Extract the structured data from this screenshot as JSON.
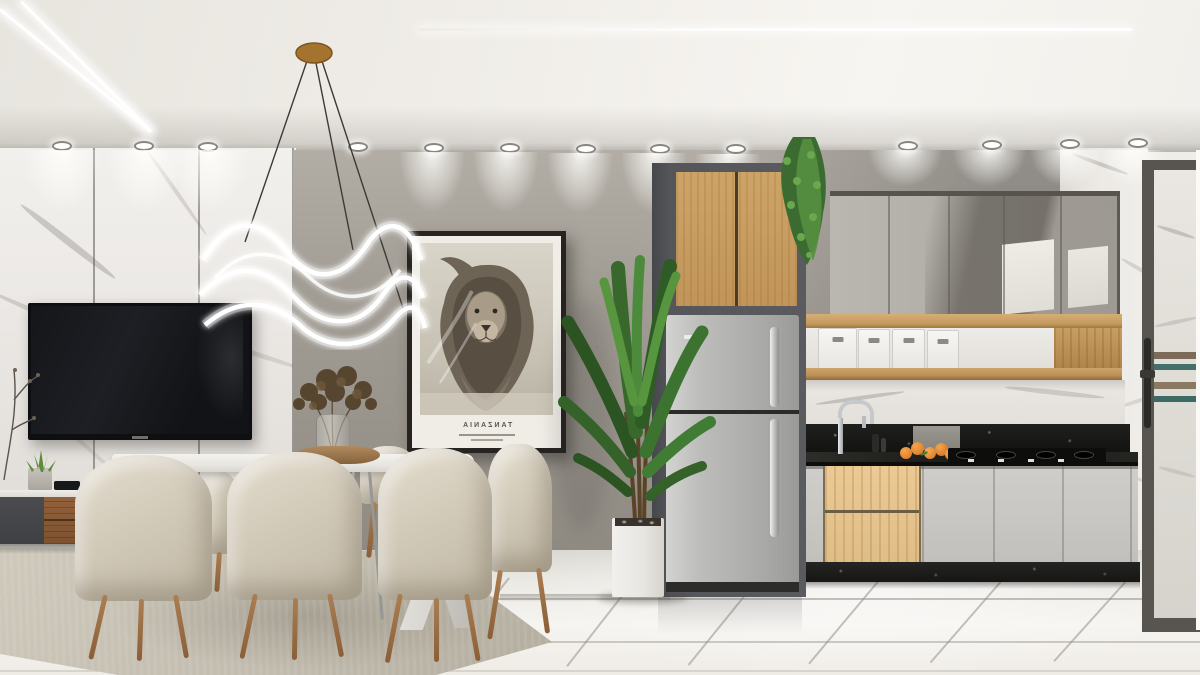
{
  "scene": {
    "type": "interior-render",
    "description": "Photorealistic 3D render of a modern apartment: dining area with six beige upholstered chairs around a white marble table beneath a wavy LED ring chandelier, wall-mounted TV on white marble panels, framed black-and-white lion poster on a concrete feature wall, tall potted palm, stainless-steel refrigerator with oak cabinet above, and a gray-and-oak kitchen run with black granite counter, mirrored upper cabinets, open oak shelf with white bins, gas cooktop and a glass door at right."
  },
  "poster": {
    "title": "TANZANIA",
    "title_mirrored": true,
    "subtitle_lines": 2,
    "subject": "lion portrait, black and white"
  },
  "inventory": {
    "dining_chairs": 6,
    "storage_bins": 4,
    "ceiling_spotlights": 13,
    "oranges": 5,
    "led_ceiling_strips": 3,
    "pendant_lights": 1
  },
  "palette": {
    "ceiling": "#f2efe9",
    "marble_wall": "#e9e6e2",
    "concrete_wall": "#9d9890",
    "cabinet_gray": "#c7c5c0",
    "oak_wood": "#c9a066",
    "walnut_wood": "#8a5c36",
    "black_granite": "#191918",
    "stainless_steel": "#b5b5b3",
    "chair_fabric": "#d6cfc0",
    "plant_green": "#3f7a33",
    "floor_tile": "#f3f1ec",
    "rug": "#c6c0b3",
    "chandelier_gold": "#a4742e",
    "led_white": "#ffffff",
    "orange_fruit": "#e0812f"
  }
}
